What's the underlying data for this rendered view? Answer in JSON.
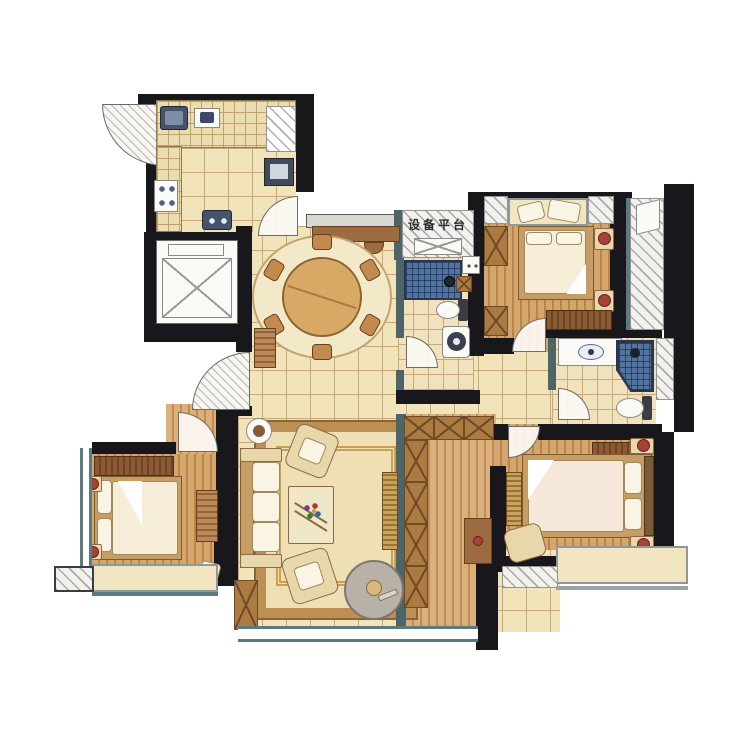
{
  "labels": {
    "equipment_platform": "设备平台"
  },
  "colors": {
    "wall": "#17171c",
    "floor_tile": "#f1e3ba",
    "tile_grid_line": "#c9a97a",
    "wood_floor": "#d5a66c",
    "wood_stripe": "#b9854e",
    "blue_tile": "#53749f",
    "window_frame_teal": "#5d7a7f",
    "rug_border": "#bc8f55",
    "rug_field": "#eee0b4",
    "cabinet_brown": "#9c6b3f",
    "lamp_accent_red": "#a84138",
    "hatch_gray": "#94948e",
    "paper_background": "#ffffff"
  }
}
